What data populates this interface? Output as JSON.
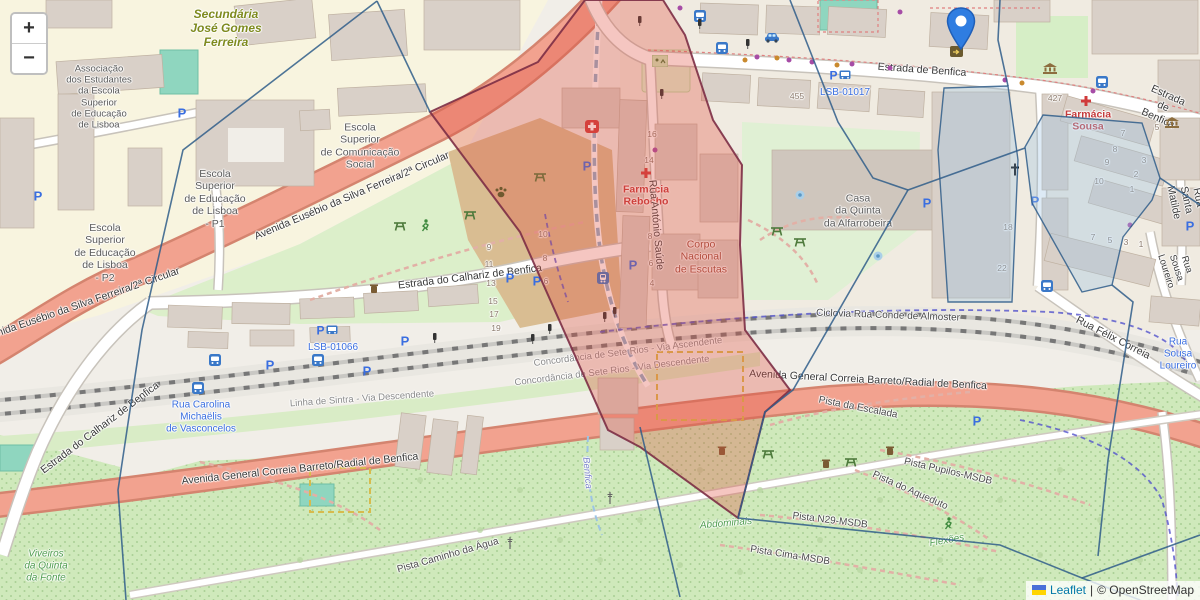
{
  "controls": {
    "zoom_in_label": "+",
    "zoom_out_label": "−"
  },
  "attribution": {
    "leaflet_link": "Leaflet",
    "separator": "|",
    "copyright_text": "© OpenStreetMap"
  },
  "marker": {
    "x": 961,
    "y": 57,
    "color": "#2f7de1"
  },
  "overlay": {
    "red_fill": "#e04f3e",
    "red_fill_opacity": 0.32,
    "red_stroke": "#7c2d45",
    "blue_stroke": "#2f5d8a",
    "cell_fill": "#9ec4e2",
    "cell_fill_opacity": 0.35,
    "red_polygon": "585,0 663,0 685,35 713,120 742,165 740,245 745,330 790,390 765,412 738,518 640,447 608,430 520,232 430,112 538,62",
    "edges": [
      "377,1 183,150 142,330 118,490 126,600",
      "377,1 430,112",
      "790,0 838,122 873,178 908,190",
      "908,190 793,390 765,412 738,518",
      "738,518 1000,545 1082,578 1140,600",
      "1082,578 1200,535",
      "908,190 1025,148",
      "640,427 680,597",
      "1112,285 1133,302 1108,460 1098,556",
      "1160,178 1200,205",
      "1008,86 998,40 1000,0"
    ],
    "cells": [
      "1043,115 1142,123 1160,178 1152,200 1123,237 1112,285 1082,292 1032,203 1025,147",
      "944,88 1008,86 1018,160 1012,302 948,302 938,150"
    ]
  },
  "labels": [
    {
      "n": "label-secundaria",
      "t": "Secundária\nJosé Gomes\nFerreira",
      "x": 226,
      "y": 28,
      "c": "olive"
    },
    {
      "n": "label-associacao",
      "t": "Associação\ndos Estudantes\nda Escola\nSuperior\nde Educação\nde Lisboa",
      "x": 99,
      "y": 97,
      "c": "place",
      "s": 9.5
    },
    {
      "n": "label-esel-p2",
      "t": "Escola\nSuperior\nde Educação\nde Lisboa\n- P2",
      "x": 105,
      "y": 253,
      "c": "place"
    },
    {
      "n": "label-esel-p1",
      "t": "Escola\nSuperior\nde Educação\nde Lisboa\n- P1",
      "x": 215,
      "y": 199,
      "c": "place"
    },
    {
      "n": "label-escs",
      "t": "Escola\nSuperior\nde Comunicação\nSocial",
      "x": 360,
      "y": 146,
      "c": "place"
    },
    {
      "n": "label-casa-quinta",
      "t": "Casa\nda Quinta\nda Alfarrobeira",
      "x": 858,
      "y": 211,
      "c": "place"
    },
    {
      "n": "label-corpo-escutas",
      "t": "Corpo\nNacional\nde Escutas",
      "x": 701,
      "y": 257,
      "c": "scout"
    },
    {
      "n": "label-viveiros",
      "t": "Viveiros\nda Quinta\nda Fonte",
      "x": 46,
      "y": 566,
      "c": "nature"
    },
    {
      "n": "label-farmacia-rebocho",
      "t": "Farmácia\nRebocho",
      "x": 646,
      "y": 196,
      "c": "red"
    },
    {
      "n": "label-farmacia-sousa",
      "t": "Farmácia\nSousa",
      "x": 1088,
      "y": 121,
      "c": "red"
    },
    {
      "n": "road-2circular-1",
      "t": "Avenida Eusébio da Silva Ferreira/2ª Circular",
      "x": 352,
      "y": 196,
      "r": -23,
      "c": "road"
    },
    {
      "n": "road-2circular-2",
      "t": "Avenida Eusébio da Silva Ferreira/2ª Circular",
      "x": 80,
      "y": 305,
      "r": -19,
      "c": "road"
    },
    {
      "n": "road-calhariz-1",
      "t": "Estrada do Calhariz de Benfica",
      "x": 470,
      "y": 277,
      "r": -7,
      "c": "road"
    },
    {
      "n": "road-calhariz-2",
      "t": "Estrada do Calhariz de Benfica",
      "x": 100,
      "y": 428,
      "r": -37,
      "c": "road"
    },
    {
      "n": "road-estrada-benfica-1",
      "t": "Estrada de Benfica",
      "x": 922,
      "y": 70,
      "r": 4,
      "c": "road"
    },
    {
      "n": "road-estrada-benfica-2",
      "t": "Estrada de Benfica",
      "x": 1163,
      "y": 107,
      "r": 24,
      "c": "road"
    },
    {
      "n": "road-avenida-general-1",
      "t": "Avenida General Correia Barreto/Radial de Benfica",
      "x": 300,
      "y": 469,
      "r": -6,
      "c": "road"
    },
    {
      "n": "road-avenida-general-2",
      "t": "Avenida General Correia Barreto/Radial de Benfica",
      "x": 868,
      "y": 380,
      "r": 3,
      "c": "road"
    },
    {
      "n": "road-antonio-saude",
      "t": "Rua António Saúde",
      "x": 656,
      "y": 225,
      "r": 85,
      "c": "road"
    },
    {
      "n": "road-felix-correia",
      "t": "Rua Félix Correia",
      "x": 1113,
      "y": 338,
      "r": 27,
      "c": "road"
    },
    {
      "n": "road-santa-matilde",
      "t": "Rua Santa Matilde",
      "x": 1186,
      "y": 200,
      "r": 78,
      "c": "road"
    },
    {
      "n": "road-sousa-loureiro",
      "t": "Rua Sousa Loureiro",
      "x": 1176,
      "y": 268,
      "r": 72,
      "c": "road",
      "s": 9.5
    },
    {
      "n": "path-ciclovia",
      "t": "Ciclovia Rua Conde de Almoster",
      "x": 888,
      "y": 316,
      "r": 2,
      "c": "path"
    },
    {
      "n": "rail-concordancia-asc",
      "t": "Concordância de Sete Rios - Via Ascendente",
      "x": 628,
      "y": 352,
      "r": -7,
      "c": "rail"
    },
    {
      "n": "rail-concordancia-desc",
      "t": "Concordância de Sete Rios - Via Descendente",
      "x": 612,
      "y": 371,
      "r": -7,
      "c": "rail"
    },
    {
      "n": "rail-linha-sintra",
      "t": "Linha de Sintra - Via Descendente",
      "x": 362,
      "y": 399,
      "r": -4,
      "c": "rail"
    },
    {
      "n": "ref-lsb-01017",
      "t": "LSB-01017",
      "x": 845,
      "y": 93,
      "c": "blue"
    },
    {
      "n": "ref-lsb-01066",
      "t": "LSB-01066",
      "x": 333,
      "y": 348,
      "c": "blue"
    },
    {
      "n": "label-rua-carolina",
      "t": "Rua Carolina\nMichaëlis\nde Vasconcelos",
      "x": 201,
      "y": 417,
      "c": "blue"
    },
    {
      "n": "label-sousa-loureiro-blue",
      "t": "Rua Sousa\nLoureiro",
      "x": 1178,
      "y": 354,
      "c": "blue"
    },
    {
      "n": "stream-benfica",
      "t": "Benfica",
      "x": 587,
      "y": 473,
      "r": 85,
      "c": "stream"
    },
    {
      "n": "nature-flexoes",
      "t": "Flexões",
      "x": 947,
      "y": 541,
      "r": -10,
      "c": "nature"
    },
    {
      "n": "nature-abdominais",
      "t": "Abdominais",
      "x": 726,
      "y": 524,
      "r": -5,
      "c": "nature"
    },
    {
      "n": "path-escalada",
      "t": "Pista da Escalada",
      "x": 858,
      "y": 408,
      "r": 11,
      "c": "path"
    },
    {
      "n": "path-pupilos",
      "t": "Pista Pupilos-MSDB",
      "x": 948,
      "y": 472,
      "r": 13,
      "c": "path"
    },
    {
      "n": "path-aqueduto",
      "t": "Pista do Aqueduto",
      "x": 910,
      "y": 491,
      "r": 24,
      "c": "path"
    },
    {
      "n": "path-n29",
      "t": "Pista N29-MSDB",
      "x": 830,
      "y": 521,
      "r": 7,
      "c": "path"
    },
    {
      "n": "path-cima",
      "t": "Pista Cima-MSDB",
      "x": 790,
      "y": 556,
      "r": 9,
      "c": "path"
    },
    {
      "n": "path-caminho-agua",
      "t": "Pista Caminho da Água",
      "x": 448,
      "y": 556,
      "r": -16,
      "c": "path"
    },
    {
      "n": "housenumber",
      "t": "455",
      "x": 797,
      "y": 96,
      "c": "num"
    },
    {
      "n": "housenumber",
      "t": "427",
      "x": 1055,
      "y": 98,
      "c": "num"
    },
    {
      "n": "housenumber",
      "t": "16",
      "x": 652,
      "y": 134,
      "c": "num"
    },
    {
      "n": "housenumber",
      "t": "14",
      "x": 649,
      "y": 160,
      "c": "num"
    },
    {
      "n": "housenumber",
      "t": "8",
      "x": 650,
      "y": 236,
      "c": "num"
    },
    {
      "n": "housenumber",
      "t": "6",
      "x": 651,
      "y": 263,
      "c": "num"
    },
    {
      "n": "housenumber",
      "t": "4",
      "x": 652,
      "y": 283,
      "c": "num"
    },
    {
      "n": "housenumber",
      "t": "10",
      "x": 543,
      "y": 234,
      "c": "num"
    },
    {
      "n": "housenumber",
      "t": "8",
      "x": 545,
      "y": 258,
      "c": "num"
    },
    {
      "n": "housenumber",
      "t": "6",
      "x": 546,
      "y": 281,
      "c": "num"
    },
    {
      "n": "housenumber",
      "t": "9",
      "x": 489,
      "y": 247,
      "c": "num"
    },
    {
      "n": "housenumber",
      "t": "11",
      "x": 489,
      "y": 264,
      "c": "num"
    },
    {
      "n": "housenumber",
      "t": "13",
      "x": 491,
      "y": 283,
      "c": "num"
    },
    {
      "n": "housenumber",
      "t": "15",
      "x": 493,
      "y": 301,
      "c": "num"
    },
    {
      "n": "housenumber",
      "t": "17",
      "x": 494,
      "y": 314,
      "c": "num"
    },
    {
      "n": "housenumber",
      "t": "19",
      "x": 496,
      "y": 328,
      "c": "num"
    },
    {
      "n": "housenumber",
      "t": "7",
      "x": 1123,
      "y": 133,
      "c": "num"
    },
    {
      "n": "housenumber",
      "t": "8",
      "x": 1115,
      "y": 149,
      "c": "num"
    },
    {
      "n": "housenumber",
      "t": "9",
      "x": 1107,
      "y": 162,
      "c": "num"
    },
    {
      "n": "housenumber",
      "t": "10",
      "x": 1099,
      "y": 181,
      "c": "num"
    },
    {
      "n": "housenumber",
      "t": "5",
      "x": 1157,
      "y": 127,
      "c": "num"
    },
    {
      "n": "housenumber",
      "t": "3",
      "x": 1144,
      "y": 160,
      "c": "num"
    },
    {
      "n": "housenumber",
      "t": "2",
      "x": 1136,
      "y": 174,
      "c": "num"
    },
    {
      "n": "housenumber",
      "t": "1",
      "x": 1132,
      "y": 189,
      "c": "num"
    },
    {
      "n": "housenumber",
      "t": "18",
      "x": 1008,
      "y": 227,
      "c": "num"
    },
    {
      "n": "housenumber",
      "t": "22",
      "x": 1002,
      "y": 268,
      "c": "num"
    },
    {
      "n": "housenumber",
      "t": "7",
      "x": 1093,
      "y": 237,
      "c": "num"
    },
    {
      "n": "housenumber",
      "t": "5",
      "x": 1110,
      "y": 240,
      "c": "num"
    },
    {
      "n": "housenumber",
      "t": "3",
      "x": 1126,
      "y": 242,
      "c": "num"
    },
    {
      "n": "housenumber",
      "t": "1",
      "x": 1141,
      "y": 244,
      "c": "num"
    }
  ],
  "icons": [
    {
      "n": "parking-icon",
      "x": 38,
      "y": 198
    },
    {
      "n": "parking-icon",
      "x": 182,
      "y": 115
    },
    {
      "n": "parking-icon",
      "x": 270,
      "y": 367
    },
    {
      "n": "parking-icon",
      "x": 367,
      "y": 373
    },
    {
      "n": "parking-icon",
      "x": 405,
      "y": 343
    },
    {
      "n": "parking-icon",
      "x": 510,
      "y": 280
    },
    {
      "n": "parking-icon",
      "x": 537,
      "y": 283
    },
    {
      "n": "parking-icon",
      "x": 587,
      "y": 168
    },
    {
      "n": "parking-icon",
      "x": 633,
      "y": 267
    },
    {
      "n": "parking-icon",
      "x": 927,
      "y": 205
    },
    {
      "n": "parking-icon",
      "x": 1035,
      "y": 203
    },
    {
      "n": "parking-icon",
      "x": 977,
      "y": 423
    },
    {
      "n": "parking-icon",
      "x": 1190,
      "y": 228
    },
    {
      "n": "parking-bus-icon",
      "x": 327,
      "y": 332
    },
    {
      "n": "parking-bus-icon",
      "x": 840,
      "y": 77
    },
    {
      "n": "bus-stop-icon",
      "x": 215,
      "y": 362
    },
    {
      "n": "bus-stop-icon",
      "x": 198,
      "y": 390
    },
    {
      "n": "bus-stop-icon",
      "x": 318,
      "y": 362
    },
    {
      "n": "bus-stop-icon",
      "x": 700,
      "y": 18
    },
    {
      "n": "bus-stop-icon",
      "x": 722,
      "y": 50
    },
    {
      "n": "bus-stop-icon",
      "x": 1102,
      "y": 84
    },
    {
      "n": "bus-stop-icon",
      "x": 1047,
      "y": 288
    },
    {
      "n": "train-station-icon",
      "x": 603,
      "y": 280
    },
    {
      "n": "pharmacy-cross-icon",
      "x": 646,
      "y": 175
    },
    {
      "n": "pharmacy-cross-icon",
      "x": 1086,
      "y": 103
    },
    {
      "n": "first-aid-icon",
      "x": 592,
      "y": 129
    },
    {
      "n": "church-cross-icon",
      "x": 1015,
      "y": 172
    },
    {
      "n": "bank-icon",
      "x": 1050,
      "y": 70
    },
    {
      "n": "bank-icon",
      "x": 1172,
      "y": 124
    },
    {
      "n": "car-icon",
      "x": 772,
      "y": 39
    },
    {
      "n": "shop-icon",
      "x": 957,
      "y": 54
    },
    {
      "n": "picnic-icon",
      "x": 400,
      "y": 227
    },
    {
      "n": "picnic-icon",
      "x": 470,
      "y": 216
    },
    {
      "n": "picnic-icon",
      "x": 540,
      "y": 178
    },
    {
      "n": "picnic-icon",
      "x": 777,
      "y": 232
    },
    {
      "n": "picnic-icon",
      "x": 800,
      "y": 243
    },
    {
      "n": "picnic-icon",
      "x": 768,
      "y": 455
    },
    {
      "n": "picnic-icon",
      "x": 851,
      "y": 463
    },
    {
      "n": "runner-icon",
      "x": 425,
      "y": 228
    },
    {
      "n": "runner-icon",
      "x": 948,
      "y": 526
    },
    {
      "n": "paw-icon",
      "x": 501,
      "y": 194
    },
    {
      "n": "trash-icon",
      "x": 374,
      "y": 290
    },
    {
      "n": "trash-icon",
      "x": 722,
      "y": 452
    },
    {
      "n": "trash-icon",
      "x": 890,
      "y": 452
    },
    {
      "n": "trash-icon",
      "x": 826,
      "y": 465
    },
    {
      "n": "fountain-icon",
      "x": 800,
      "y": 196
    },
    {
      "n": "fountain-icon",
      "x": 878,
      "y": 257
    },
    {
      "n": "playground-icon",
      "x": 660,
      "y": 63
    },
    {
      "n": "traffic-light-icon",
      "x": 435,
      "y": 339
    },
    {
      "n": "traffic-light-icon",
      "x": 533,
      "y": 340
    },
    {
      "n": "traffic-light-icon",
      "x": 550,
      "y": 330
    },
    {
      "n": "traffic-light-icon",
      "x": 605,
      "y": 318
    },
    {
      "n": "traffic-light-icon",
      "x": 615,
      "y": 313
    },
    {
      "n": "traffic-light-icon",
      "x": 640,
      "y": 22
    },
    {
      "n": "traffic-light-icon",
      "x": 700,
      "y": 25
    },
    {
      "n": "traffic-light-icon",
      "x": 748,
      "y": 45
    },
    {
      "n": "traffic-light-icon",
      "x": 662,
      "y": 95
    },
    {
      "n": "mast-icon",
      "x": 610,
      "y": 500
    },
    {
      "n": "mast-icon",
      "x": 510,
      "y": 545
    }
  ],
  "dots": [
    {
      "x": 757,
      "y": 57,
      "c": "#a64ca6"
    },
    {
      "x": 789,
      "y": 60,
      "c": "#a64ca6"
    },
    {
      "x": 812,
      "y": 62,
      "c": "#a64ca6"
    },
    {
      "x": 852,
      "y": 64,
      "c": "#a64ca6"
    },
    {
      "x": 890,
      "y": 68,
      "c": "#a64ca6"
    },
    {
      "x": 1005,
      "y": 80,
      "c": "#a64ca6"
    },
    {
      "x": 1093,
      "y": 91,
      "c": "#a64ca6"
    },
    {
      "x": 680,
      "y": 8,
      "c": "#a64ca6"
    },
    {
      "x": 900,
      "y": 12,
      "c": "#a64ca6"
    },
    {
      "x": 1130,
      "y": 225,
      "c": "#a64ca6"
    },
    {
      "x": 655,
      "y": 150,
      "c": "#a64ca6"
    },
    {
      "x": 777,
      "y": 58,
      "c": "#c98a2e"
    },
    {
      "x": 837,
      "y": 65,
      "c": "#c98a2e"
    },
    {
      "x": 1022,
      "y": 83,
      "c": "#c98a2e"
    },
    {
      "x": 745,
      "y": 60,
      "c": "#c98a2e"
    }
  ],
  "trees": [
    [
      700,
      470
    ],
    [
      760,
      490
    ],
    [
      820,
      540
    ],
    [
      880,
      500
    ],
    [
      940,
      560
    ],
    [
      640,
      520
    ],
    [
      560,
      540
    ],
    [
      480,
      530
    ],
    [
      1000,
      500
    ],
    [
      1060,
      470
    ],
    [
      1100,
      520
    ],
    [
      420,
      480
    ],
    [
      350,
      520
    ],
    [
      300,
      560
    ],
    [
      680,
      565
    ],
    [
      740,
      572
    ],
    [
      980,
      580
    ],
    [
      1140,
      560
    ],
    [
      520,
      490
    ],
    [
      600,
      560
    ],
    [
      860,
      570
    ],
    [
      1040,
      555
    ]
  ]
}
